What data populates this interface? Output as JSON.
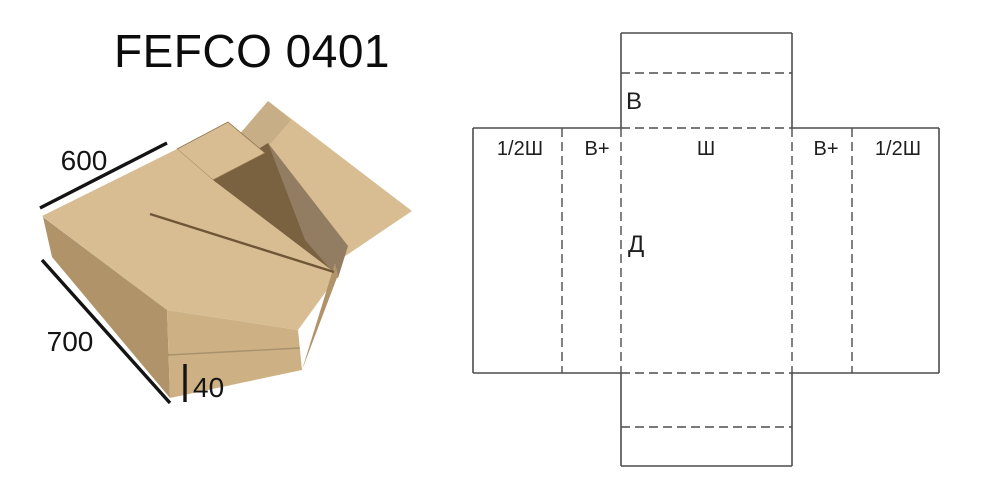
{
  "title": "FEFCO 0401",
  "photo": {
    "dim_top": "600",
    "dim_side": "700",
    "dim_height": "40",
    "colors": {
      "kraft_light": "#d8bd93",
      "kraft_mid": "#cdb184",
      "kraft_dark": "#b1936a",
      "interior": "#7a6140",
      "edge": "#6f5636",
      "dim_line": "#141414"
    }
  },
  "diagram": {
    "panel_labels": [
      "1/2Ш",
      "В+",
      "Ш",
      "В+",
      "1/2Ш"
    ],
    "top_flap_label": "В",
    "depth_label": "Д",
    "line_color": "#4d4d4d",
    "text_color": "#1f1f1f"
  }
}
